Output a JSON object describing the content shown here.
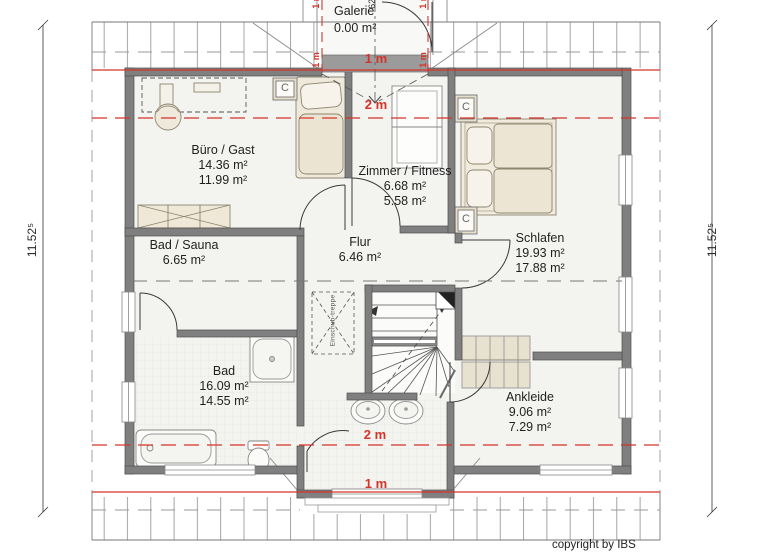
{
  "plan": {
    "rooms": [
      {
        "name": "Büro / Gast",
        "area_gross": "14.36 m²",
        "area_net": "11.99 m²"
      },
      {
        "name": "Zimmer / Fitness",
        "area_gross": "6.68 m²",
        "area_net": "5.58 m²"
      },
      {
        "name": "Schlafen",
        "area_gross": "19.93 m²",
        "area_net": "17.88 m²"
      },
      {
        "name": "Bad / Sauna",
        "area_gross": "6.65 m²",
        "area_net": ""
      },
      {
        "name": "Flur",
        "area_gross": "6.46 m²",
        "area_net": ""
      },
      {
        "name": "Bad",
        "area_gross": "16.09 m²",
        "area_net": "14.55 m²"
      },
      {
        "name": "Ankleide",
        "area_gross": "9.06 m²",
        "area_net": "7.29 m²"
      },
      {
        "name": "Galerie",
        "area_gross": "0.00 m²",
        "area_net": ""
      }
    ],
    "height_markers": {
      "one_meter": "1 m",
      "two_meter": "2 m"
    },
    "dimensions": {
      "side_total": "11.52⁵",
      "gallery_width": "62⁵"
    },
    "annotations": {
      "attic_ladder": "Einschub-treppe",
      "chimney": "C",
      "copyright": "copyright by IBS"
    },
    "colors": {
      "height_line_red": "#d5332a",
      "wall_gray": "#7f7f7f",
      "furniture_beige": "#eae2d1",
      "floor": "#f3f3f0"
    }
  }
}
